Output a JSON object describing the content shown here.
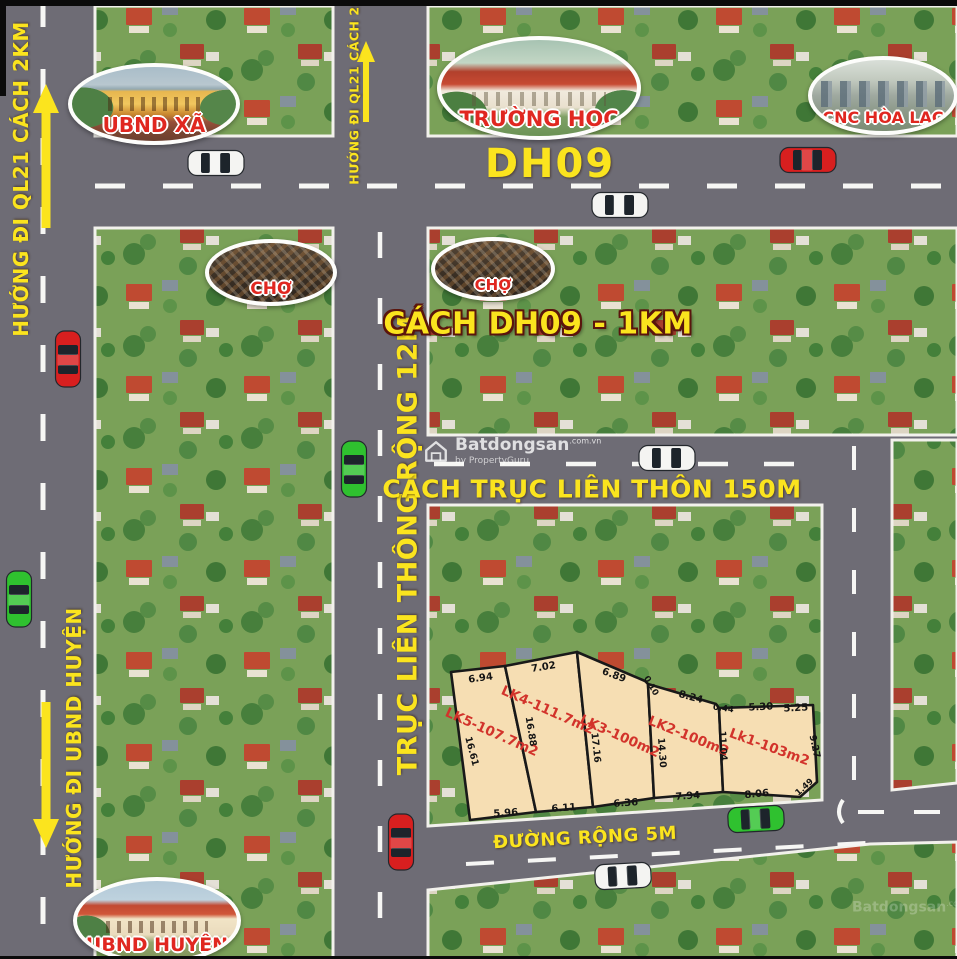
{
  "roads": {
    "dh09_label": "DH09",
    "main_axis_label": "TRỤC LIÊN THÔNG RỘNG 12M",
    "village_axis_label": "CÁCH TRỤC LIÊN THÔN 150M",
    "dh09_distance_label": "CÁCH DH09 - 1KM",
    "small_road_label": "ĐƯỜNG RỘNG 5M",
    "dir_ql21_left": "HƯỚNG ĐI QL21 CÁCH 2KM",
    "dir_ql21_mid": "HƯỚNG ĐI QL21 CÁCH 2KM",
    "dir_ubnd_huyen": "HƯỚNG ĐI UBND HUYỆN"
  },
  "landmarks": {
    "ubnd_xa": "UBND XÃ",
    "truong_hoc": "TRƯỜNG HỌC",
    "cnc_hoa_lac": "CNC HÒA LẠC",
    "cho_1": "CHỢ",
    "cho_2": "CHỢ",
    "ubnd_huyen": "UBND HUYỆN"
  },
  "plots": {
    "names": [
      "LK5-107.7m2",
      "LK4-111.7m2",
      "LK3-100m2",
      "LK2-100m2",
      "Lk1-103m2"
    ],
    "dims_top": [
      "6.94",
      "7.02",
      "6.89",
      "0.10",
      "8.24",
      "0.44",
      "5.30",
      "5.25"
    ],
    "dims_side": [
      "16.61",
      "16.88",
      "17.16",
      "14.30",
      "11.04",
      "9.27"
    ],
    "dims_bottom": [
      "5.96",
      "6.11",
      "6.36",
      "7.94",
      "8.06",
      "1.49"
    ]
  },
  "watermark": {
    "brand": "Batdongsan",
    "domain": ".com.vn",
    "byline": "by PropertyGuru"
  },
  "colors": {
    "road": "#6e6c75",
    "accent_yellow": "#fbe41e",
    "plot_fill": "#f6deb3",
    "plot_label_red": "#d2332b",
    "aerial_green": "#7aa158"
  }
}
